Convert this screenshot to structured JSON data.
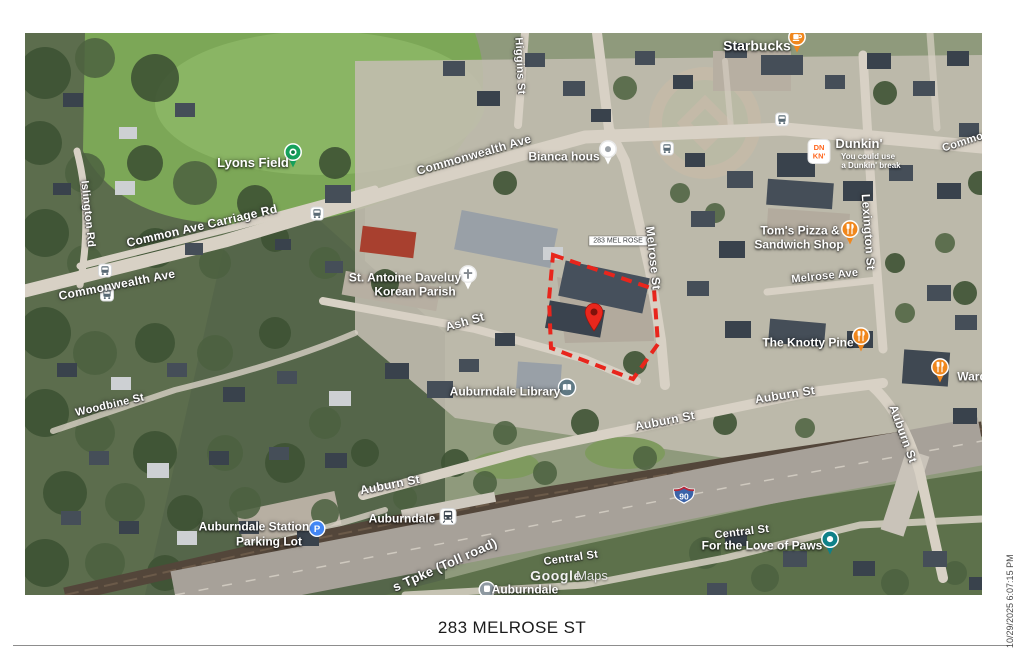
{
  "page": {
    "caption": "283 MELROSE ST",
    "timestamp": "10/29/2025 6:07:15 PM"
  },
  "map": {
    "colors": {
      "property_outline": "#e8251c",
      "property_pin": "#e9271d",
      "poi_orange": "#f0871d",
      "parking_blue": "#4286f5",
      "lyons_green": "#16a15c",
      "paws_teal": "#0f8189",
      "dunkin_orange": "#ff671f"
    },
    "labels": [
      {
        "t": "Starbucks",
        "x": 732,
        "y": 13,
        "s": 14,
        "k": "poi"
      },
      {
        "t": "Commo",
        "x": 938,
        "y": 110,
        "r": -18,
        "s": 11,
        "k": "road"
      },
      {
        "t": "Dunkin'",
        "x": 834,
        "y": 111,
        "s": 13,
        "k": "poi"
      },
      {
        "t": "You could use",
        "x": 843,
        "y": 124,
        "s": 8,
        "k": "tag"
      },
      {
        "t": "a Dunkin' break",
        "x": 846,
        "y": 133,
        "s": 8,
        "k": "tag"
      },
      {
        "t": "Bianca hous",
        "x": 539,
        "y": 124,
        "s": 12,
        "k": "poi"
      },
      {
        "t": "Lyons Field",
        "x": 228,
        "y": 130,
        "s": 13,
        "k": "poi"
      },
      {
        "t": "Commonwealth Ave",
        "x": 449,
        "y": 122,
        "r": -16,
        "s": 12,
        "k": "road"
      },
      {
        "t": "Higgins St",
        "x": 494,
        "y": 33,
        "r": 87,
        "s": 11,
        "k": "road"
      },
      {
        "t": "Common Ave Carriage Rd",
        "x": 177,
        "y": 193,
        "r": -13,
        "s": 12,
        "k": "road"
      },
      {
        "t": "Islington Rd",
        "x": 62,
        "y": 181,
        "r": 84,
        "s": 11,
        "k": "road"
      },
      {
        "t": "Commonwealth Ave",
        "x": 92,
        "y": 252,
        "r": -11,
        "s": 12,
        "k": "road"
      },
      {
        "t": "St. Antoine Daveluy",
        "x": 380,
        "y": 245,
        "s": 12,
        "k": "poi"
      },
      {
        "t": "Korean Parish",
        "x": 390,
        "y": 259,
        "s": 12,
        "k": "poi"
      },
      {
        "t": "Ash St",
        "x": 440,
        "y": 289,
        "r": -16,
        "s": 12,
        "k": "road"
      },
      {
        "t": "283 MEL ROSE",
        "x": 593,
        "y": 208,
        "s": 7,
        "k": "plabel"
      },
      {
        "t": "Melrose St",
        "x": 628,
        "y": 225,
        "r": 84,
        "s": 12,
        "k": "road"
      },
      {
        "t": "Tom's Pizza &",
        "x": 775,
        "y": 198,
        "s": 12,
        "k": "poi"
      },
      {
        "t": "Sandwich Shop",
        "x": 774,
        "y": 212,
        "s": 12,
        "k": "poi"
      },
      {
        "t": "Melrose Ave",
        "x": 800,
        "y": 244,
        "r": -6,
        "s": 11,
        "k": "road"
      },
      {
        "t": "Lexington St",
        "x": 843,
        "y": 199,
        "r": 86,
        "s": 12,
        "k": "road"
      },
      {
        "t": "The Knotty Pine",
        "x": 783,
        "y": 310,
        "s": 12,
        "k": "poi"
      },
      {
        "t": "Ward",
        "x": 947,
        "y": 344,
        "s": 12,
        "k": "poi"
      },
      {
        "t": "Auburndale Library",
        "x": 480,
        "y": 359,
        "s": 12,
        "k": "poi"
      },
      {
        "t": "Auburn St",
        "x": 640,
        "y": 388,
        "r": -11,
        "s": 12,
        "k": "road"
      },
      {
        "t": "Auburn St",
        "x": 760,
        "y": 362,
        "r": -9,
        "s": 12,
        "k": "road"
      },
      {
        "t": "Auburn St",
        "x": 878,
        "y": 401,
        "r": 70,
        "s": 12,
        "k": "road"
      },
      {
        "t": "Woodbine St",
        "x": 85,
        "y": 373,
        "r": -13,
        "s": 11,
        "k": "road"
      },
      {
        "t": "Auburndale Station",
        "x": 229,
        "y": 494,
        "s": 12,
        "k": "poi"
      },
      {
        "t": "Parking Lot",
        "x": 244,
        "y": 509,
        "s": 12,
        "k": "poi"
      },
      {
        "t": "Auburn St",
        "x": 365,
        "y": 452,
        "r": -11,
        "s": 12,
        "k": "road"
      },
      {
        "t": "Auburndale",
        "x": 377,
        "y": 486,
        "s": 12,
        "k": "poi"
      },
      {
        "t": "s Tpke (Toll road)",
        "x": 420,
        "y": 532,
        "r": -24,
        "s": 13,
        "k": "road"
      },
      {
        "t": "Central St",
        "x": 546,
        "y": 526,
        "r": -8,
        "s": 11,
        "k": "road"
      },
      {
        "t": "Google",
        "x": 531,
        "y": 543,
        "s": 14,
        "k": "wm1"
      },
      {
        "t": "Maps",
        "x": 567,
        "y": 543,
        "s": 13,
        "k": "wm2"
      },
      {
        "t": "Auburndale",
        "x": 500,
        "y": 557,
        "s": 12,
        "k": "poi"
      },
      {
        "t": "Central St",
        "x": 717,
        "y": 500,
        "r": -7,
        "s": 11,
        "k": "road"
      },
      {
        "t": "For the Love of Paws",
        "x": 737,
        "y": 513,
        "s": 12,
        "k": "poi"
      }
    ],
    "markers": [
      {
        "icon": "coffee",
        "x": 772,
        "y": 10,
        "n": "starbucks-marker"
      },
      {
        "icon": "dunkin-logo",
        "x": 794,
        "y": 121,
        "n": "dunkin-logo"
      },
      {
        "icon": "green-dot",
        "x": 268,
        "y": 125,
        "n": "lyons-field-marker"
      },
      {
        "icon": "white-dot",
        "x": 583,
        "y": 122,
        "n": "bianca-house-marker"
      },
      {
        "icon": "church",
        "x": 443,
        "y": 247,
        "n": "korean-parish-marker"
      },
      {
        "icon": "bus",
        "x": 757,
        "y": 89,
        "n": "bus-stop-icon"
      },
      {
        "icon": "bus",
        "x": 642,
        "y": 118,
        "n": "bus-stop-icon"
      },
      {
        "icon": "bus",
        "x": 292,
        "y": 183,
        "n": "bus-stop-icon"
      },
      {
        "icon": "bus",
        "x": 80,
        "y": 240,
        "n": "bus-stop-icon"
      },
      {
        "icon": "bus",
        "x": 82,
        "y": 264,
        "n": "bus-stop-icon"
      },
      {
        "icon": "restaurant",
        "x": 825,
        "y": 202,
        "n": "toms-pizza-marker"
      },
      {
        "icon": "restaurant",
        "x": 836,
        "y": 309,
        "n": "knotty-pine-marker"
      },
      {
        "icon": "restaurant",
        "x": 915,
        "y": 340,
        "n": "ward-marker"
      },
      {
        "icon": "library",
        "x": 542,
        "y": 357,
        "n": "library-marker"
      },
      {
        "icon": "parking",
        "x": 292,
        "y": 498,
        "n": "parking-marker"
      },
      {
        "icon": "train",
        "x": 423,
        "y": 486,
        "n": "train-station-marker"
      },
      {
        "icon": "paws",
        "x": 805,
        "y": 512,
        "n": "paws-marker"
      },
      {
        "icon": "rail-circle",
        "x": 462,
        "y": 559,
        "n": "auburndale-rail-marker"
      },
      {
        "icon": "interstate-90",
        "x": 659,
        "y": 463,
        "n": "i90-shield",
        "label": "90"
      },
      {
        "icon": "red-pin",
        "x": 569,
        "y": 286,
        "n": "property-pin"
      }
    ]
  }
}
